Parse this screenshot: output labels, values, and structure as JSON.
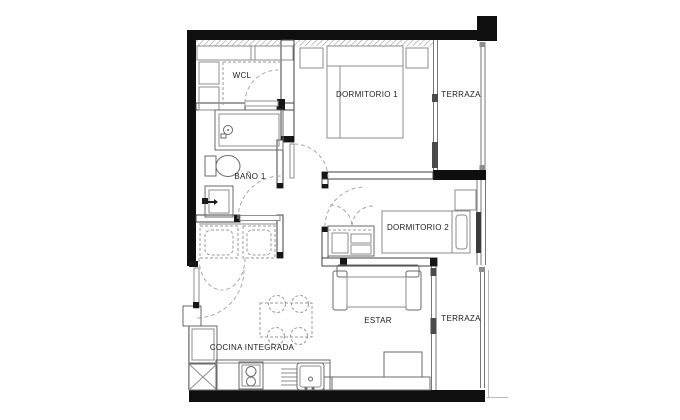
{
  "plan": {
    "title": "apartment-floor-plan",
    "rooms": [
      {
        "label": "WCL"
      },
      {
        "label": "DORMITORIO 1"
      },
      {
        "label": "TERRAZA"
      },
      {
        "label": "BAÑO 1"
      },
      {
        "label": "DORMITORIO 2"
      },
      {
        "label": "ESTAR"
      },
      {
        "label": "COCINA INTEGRADA"
      },
      {
        "label": "TERRAZA"
      }
    ],
    "colors": {
      "background": "#ffffff",
      "exterior_wall": "#0f0f0f",
      "partition_line": "#3f3f3f",
      "furniture_line": "#8e8e8e",
      "dashed_line": "#9a9a9a",
      "label_text": "#1c1c1c"
    }
  }
}
